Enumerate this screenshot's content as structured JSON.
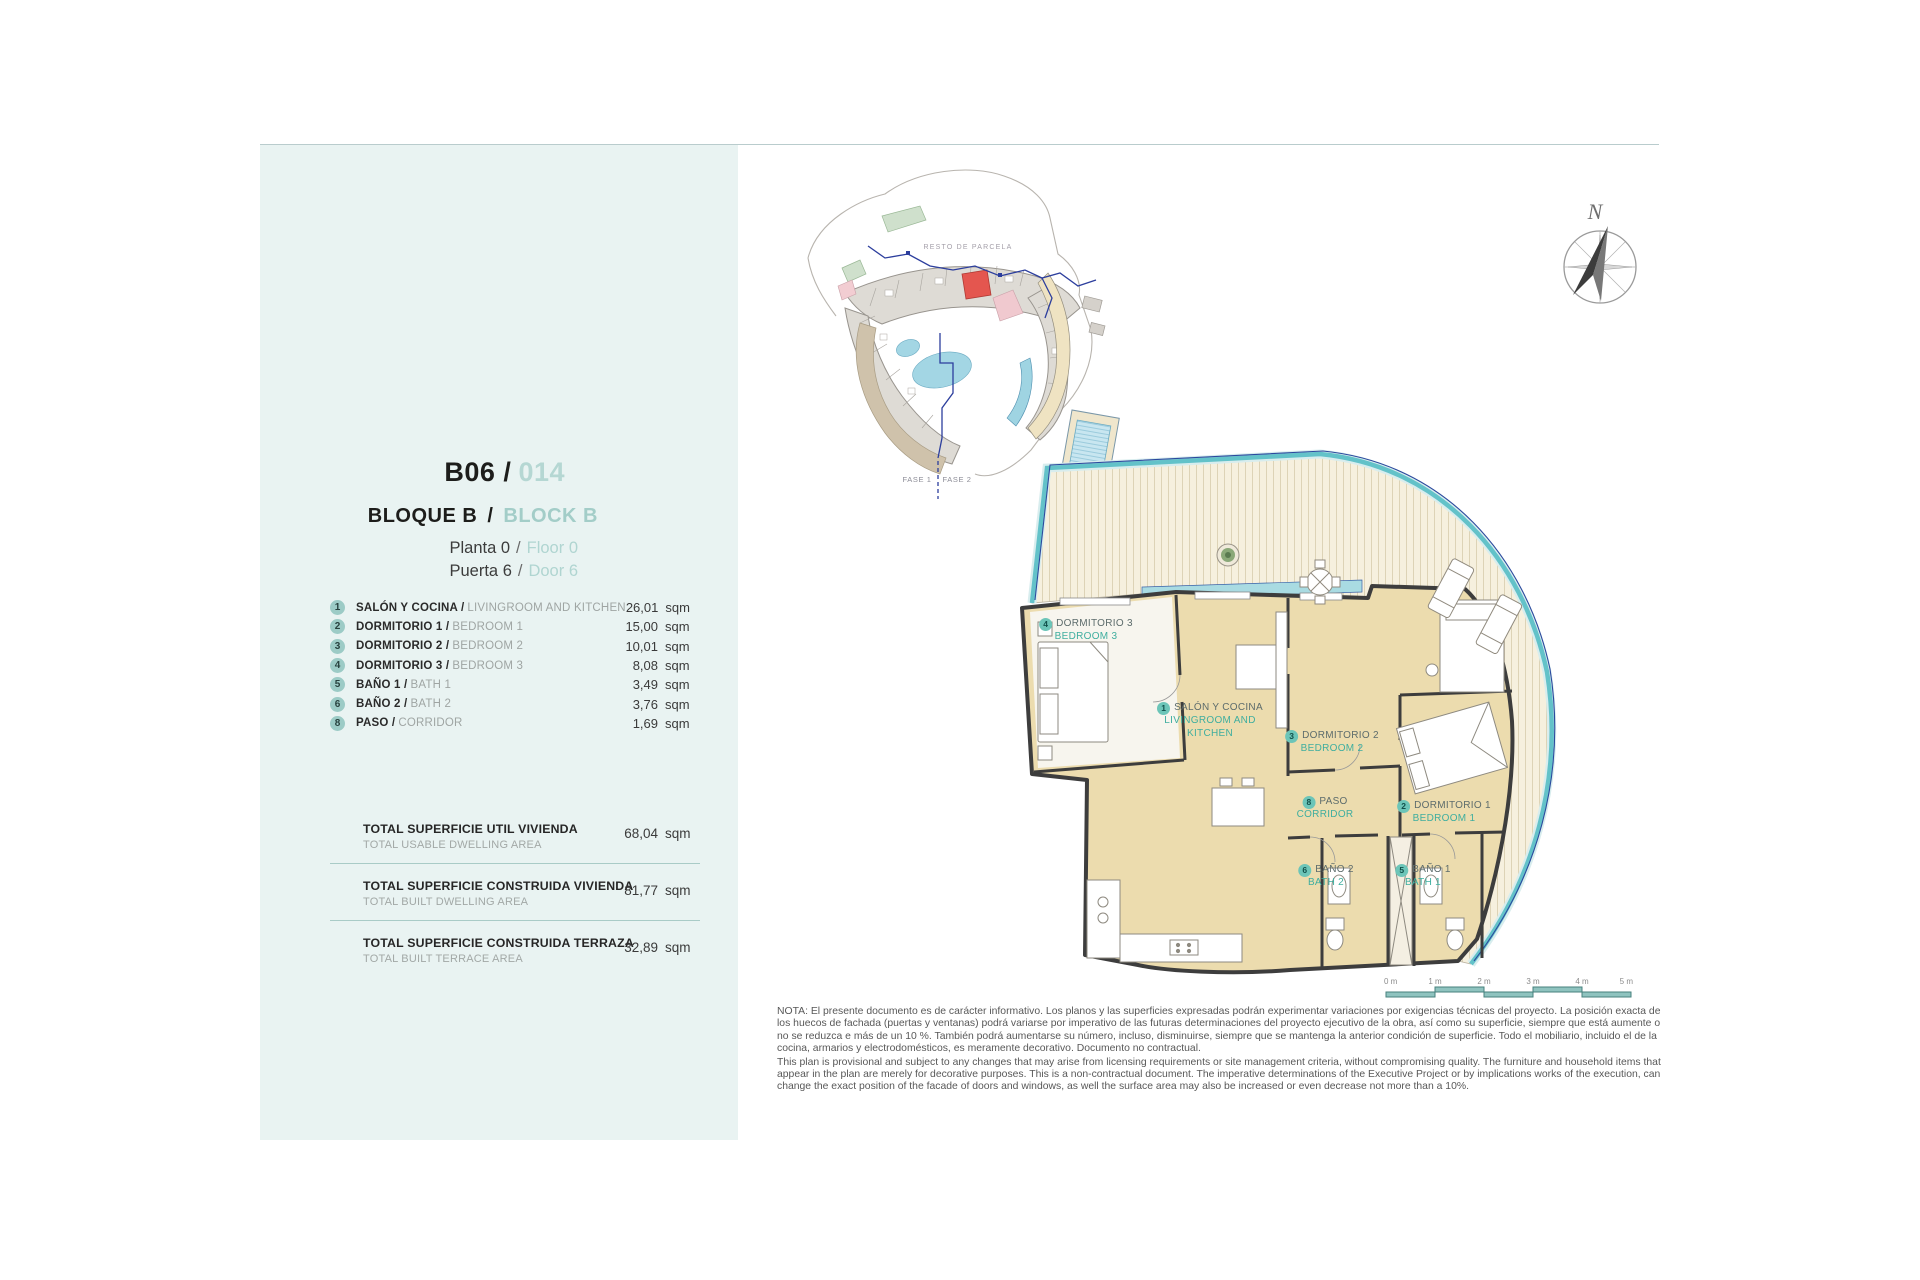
{
  "page": {
    "bg": "#ffffff",
    "accent_teal": "#6cc5b8",
    "sidebar_bg": "#e9f3f2",
    "highlight_red": "#e4564f"
  },
  "sidebar": {
    "unit": {
      "code": "B06 /",
      "number": "014"
    },
    "block": {
      "es": "BLOQUE B",
      "sep": "/",
      "en": "BLOCK B"
    },
    "floor": {
      "es": "Planta 0",
      "sep": "/",
      "en": "Floor 0"
    },
    "door": {
      "es": "Puerta 6",
      "sep": "/",
      "en": "Door 6"
    },
    "rooms": [
      {
        "num": "1",
        "es": "SALÓN Y COCINA /",
        "en": "LIVINGROOM AND KITCHEN",
        "area": "26,01",
        "unit": "sqm"
      },
      {
        "num": "2",
        "es": "DORMITORIO 1 /",
        "en": "BEDROOM 1",
        "area": "15,00",
        "unit": "sqm"
      },
      {
        "num": "3",
        "es": "DORMITORIO 2 /",
        "en": "BEDROOM 2",
        "area": "10,01",
        "unit": "sqm"
      },
      {
        "num": "4",
        "es": "DORMITORIO 3 /",
        "en": "BEDROOM 3",
        "area": "8,08",
        "unit": "sqm"
      },
      {
        "num": "5",
        "es": "BAÑO 1 /",
        "en": "BATH 1",
        "area": "3,49",
        "unit": "sqm"
      },
      {
        "num": "6",
        "es": "BAÑO 2 /",
        "en": "BATH 2",
        "area": "3,76",
        "unit": "sqm"
      },
      {
        "num": "8",
        "es": "PASO /",
        "en": "CORRIDOR",
        "area": "1,69",
        "unit": "sqm"
      }
    ],
    "totals": [
      {
        "es": "TOTAL SUPERFICIE UTIL VIVIENDA",
        "en": "TOTAL USABLE DWELLING AREA",
        "value": "68,04",
        "unit": "sqm"
      },
      {
        "es": "TOTAL SUPERFICIE CONSTRUIDA VIVIENDA",
        "en": "TOTAL BUILT DWELLING AREA",
        "value": "81,77",
        "unit": "sqm"
      },
      {
        "es": "TOTAL SUPERFICIE CONSTRUIDA TERRAZA",
        "en": "TOTAL BUILT TERRACE AREA",
        "value": "32,89",
        "unit": "sqm"
      }
    ]
  },
  "site_plan": {
    "area_label": "RESTO DE PARCELA",
    "phase1": "FASE 1",
    "phase2": "FASE 2"
  },
  "compass": {
    "north": "N"
  },
  "floor_plan": {
    "labels": [
      {
        "num": "4",
        "es": "DORMITORIO 3",
        "en": "BEDROOM 3"
      },
      {
        "num": "1",
        "es": "SALÓN Y COCINA",
        "en": "LIVINGROOM AND KITCHEN"
      },
      {
        "num": "3",
        "es": "DORMITORIO 2",
        "en": "BEDROOM 2"
      },
      {
        "num": "8",
        "es": "PASO",
        "en": "CORRIDOR"
      },
      {
        "num": "2",
        "es": "DORMITORIO 1",
        "en": "BEDROOM 1"
      },
      {
        "num": "6",
        "es": "BAÑO 2",
        "en": "BATH 2"
      },
      {
        "num": "5",
        "es": "BAÑO 1",
        "en": "BATH 1"
      }
    ]
  },
  "scale_bar": {
    "ticks": [
      "0 m",
      "1 m",
      "2 m",
      "3 m",
      "4 m",
      "5 m"
    ]
  },
  "disclaimer": {
    "es": "NOTA: El presente documento es de carácter informativo. Los planos y las superficies expresadas podrán experimentar variaciones por exigencias técnicas del proyecto. La posición exacta de los huecos de fachada (puertas y ventanas) podrá variarse por imperativo de las futuras determinaciones del proyecto ejecutivo de la obra, así como su superficie, siempre que está aumente o no se reduzca e más de un 10 %. También podrá aumentarse su número, incluso, disminuirse, siempre que se mantenga la anterior condición de superficie. Todo el mobiliario, incluido el de la cocina, armarios y electrodomésticos, es meramente decorativo. Documento no contractual.",
    "en": "This plan is provisional and subject to any changes that may arise from licensing requirements or site management criteria, without compromising quality. The furniture and household items that appear in the plan are merely for decorative purposes. This is a non-contractual document. The imperative determinations of the Executive Project or by implications works of the execution, can change the exact position of the facade of doors and windows, as well the surface area may also be increased or even decrease not more than a 10%."
  }
}
